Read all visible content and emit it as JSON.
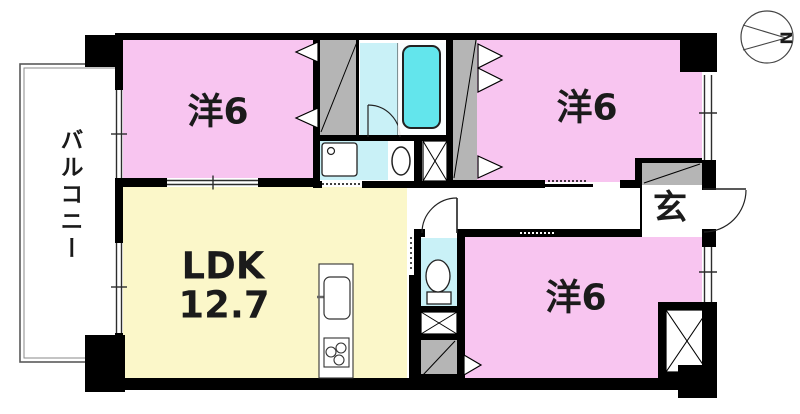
{
  "floor_plan": {
    "balcony": {
      "label": "バルコニー"
    },
    "rooms": {
      "bedroom_top_left": {
        "label": "洋6"
      },
      "bedroom_top_right": {
        "label": "洋6"
      },
      "bedroom_bottom_right": {
        "label": "洋6"
      },
      "ldk": {
        "label": "LDK",
        "area": "12.7"
      },
      "entrance": {
        "label": "玄"
      }
    },
    "compass": {
      "north_label": "N"
    },
    "colors": {
      "bedroom_pink": "#F8C5F0",
      "ldk_yellow": "#FBF7C9",
      "wet_area_cyan": "#C9F1F7",
      "bathtub_cyan": "#63E5EC",
      "closet_gray": "#B5B5B5",
      "wall_black": "#000000"
    }
  }
}
